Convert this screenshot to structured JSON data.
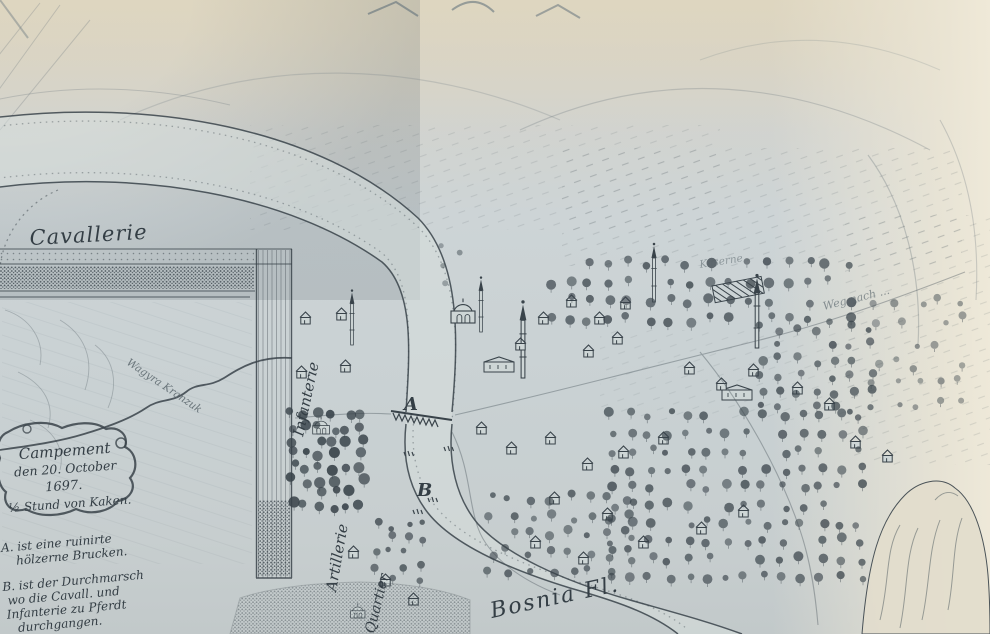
{
  "map": {
    "labels": {
      "cavallerie": "Cavallerie",
      "infanterie": "Infanterie",
      "artillerie": "Artillerie",
      "quartier": "Quartier",
      "river": "Bosnia Fl.",
      "stream": "Wagyra Kranzuk",
      "road_hint": "Weg nach ...",
      "barracks_hint": "Kaserne"
    },
    "markers": {
      "bridge": "A",
      "ford": "B"
    },
    "cartouche_lines": [
      "Campement",
      "den 20. October",
      "1697.",
      "½ Stund von Kaken."
    ],
    "legend_a_lines": [
      "A. ist eine ruinirte",
      "hölzerne Brucken."
    ],
    "legend_b_lines": [
      "B. ist der Durchmarsch",
      "wo die Cavall. und",
      "Infanterie zu Pferdt",
      "durchgangen."
    ],
    "colors": {
      "paper_cool": "#cbd3d5",
      "paper_warm": "#dcd5c3",
      "paper_bright": "#ebe5d4",
      "ink": "#39434a",
      "ink_faint": "#8a959b"
    }
  }
}
